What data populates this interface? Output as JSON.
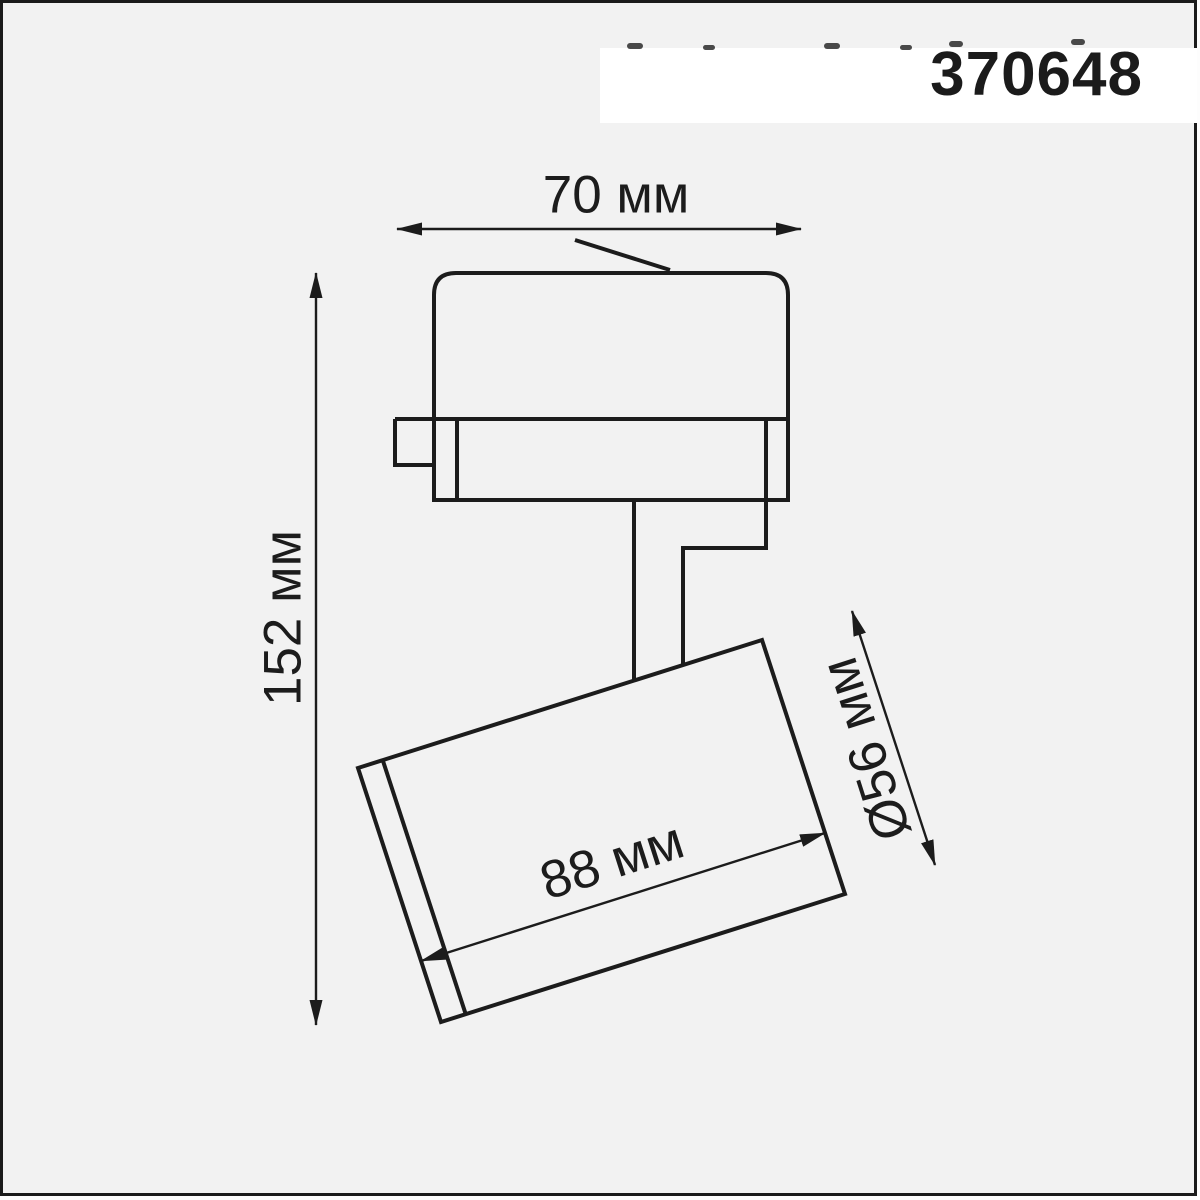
{
  "product": {
    "number": "370648"
  },
  "diagram": {
    "type": "technical-drawing",
    "subject": "track spotlight fixture, side view with dimensions",
    "dimensions": [
      {
        "id": "width",
        "label": "70 мм",
        "value": 70,
        "unit": "мм",
        "measures": "track adapter width"
      },
      {
        "id": "height",
        "label": "152 мм",
        "value": 152,
        "unit": "мм",
        "measures": "overall fixture height"
      },
      {
        "id": "length",
        "label": "88 мм",
        "value": 88,
        "unit": "мм",
        "measures": "spot head body length"
      },
      {
        "id": "diameter",
        "label": "Ø56 мм",
        "value": 56,
        "unit": "мм",
        "measures": "spot head diameter"
      }
    ]
  },
  "colors": {
    "background": "#f2f2f2",
    "band": "#ffffff",
    "line": "#1c1c1c",
    "frame": "#1b1b1b"
  }
}
